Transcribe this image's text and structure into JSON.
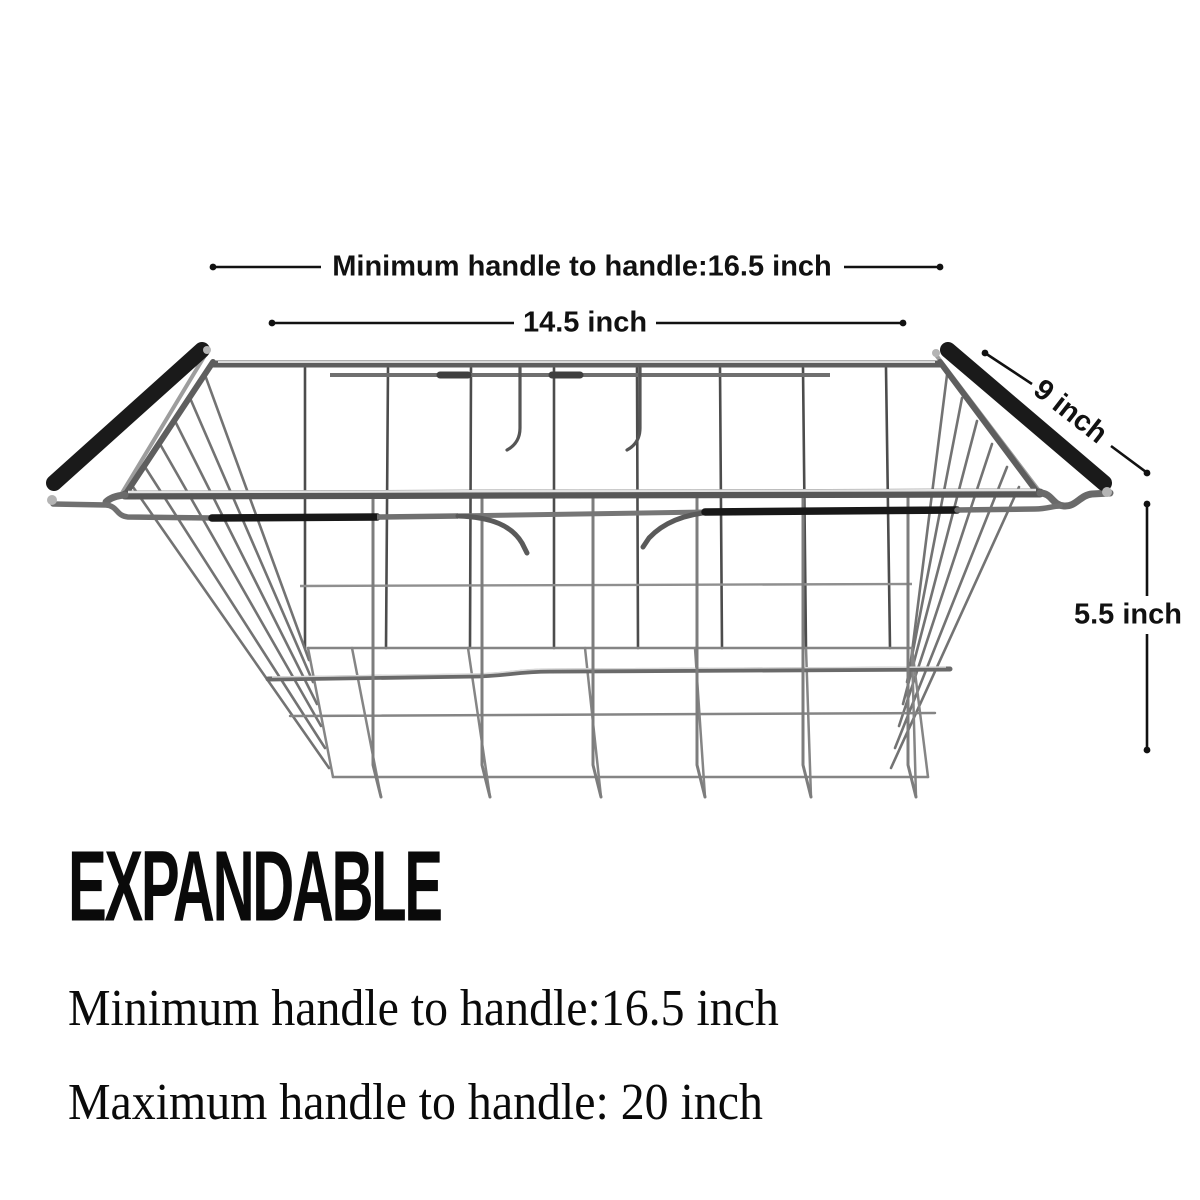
{
  "annotations": {
    "min_handle_dim": {
      "label": "Minimum handle to handle:16.5 inch"
    },
    "width_dim": {
      "label": "14.5 inch"
    },
    "depth_dim": {
      "label": "9 inch"
    },
    "height_dim": {
      "label": "5.5 inch"
    }
  },
  "caption": {
    "heading": "EXPANDABLE",
    "line1": "Minimum handle to handle:16.5 inch",
    "line2": "Maximum handle to handle: 20 inch"
  },
  "colors": {
    "annotation": "#111111",
    "handle_grip": "#1a1a1a",
    "wire_mid": "#7a7a7a",
    "wire_dark": "#4c4c4c",
    "wire_light": "#9d9d9d",
    "background": "#ffffff"
  }
}
